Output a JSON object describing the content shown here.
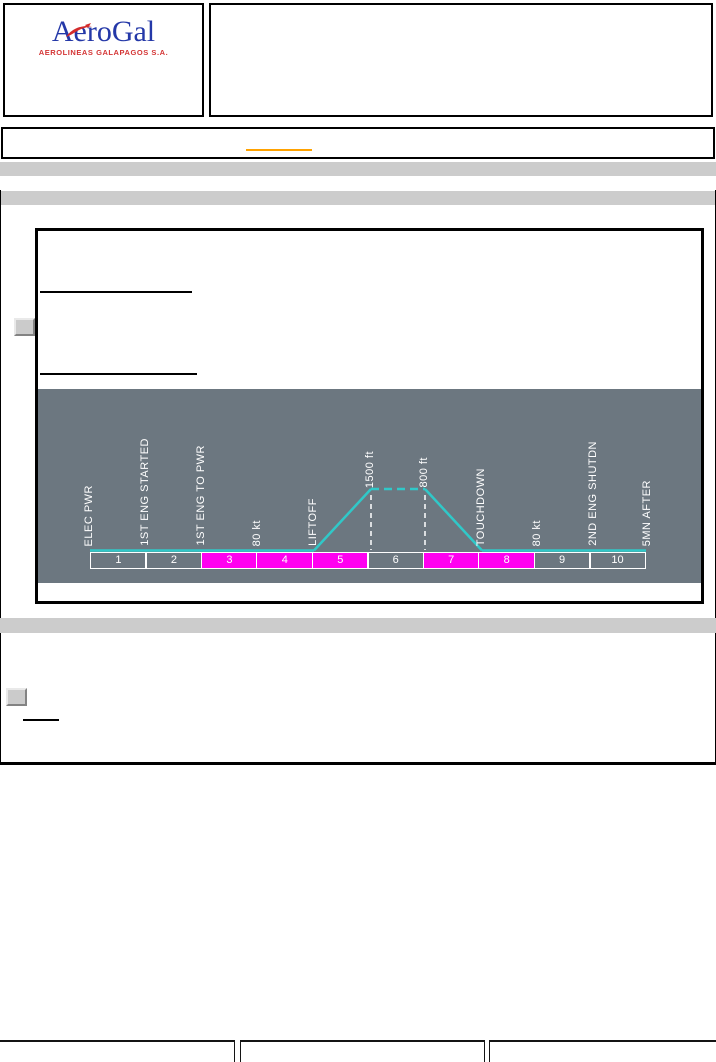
{
  "colors": {
    "accent": "#ffa200",
    "bar": "#cccccc",
    "panel-bg": "#6c7780",
    "hl": "#ff00f0",
    "path": "#30c8c8",
    "logo-blue": "#2438a8",
    "logo-red": "#d43535"
  },
  "header": {
    "logo_title": "AeroGal",
    "logo_subtitle": "AEROLINEAS GALAPAGOS S.A."
  },
  "diagram": {
    "type": "flight-phase-timeline",
    "events": [
      {
        "label": "ELEC PWR"
      },
      {
        "label": "1ST ENG STARTED"
      },
      {
        "label": "1ST ENG TO PWR"
      },
      {
        "label": "80 kt"
      },
      {
        "label": "LIFTOFF"
      },
      {
        "label": "1500 ft"
      },
      {
        "label": "800 ft"
      },
      {
        "label": "TOUCHDOWN"
      },
      {
        "label": "80 kt"
      },
      {
        "label": "2ND ENG SHUTDN"
      },
      {
        "label": "5MN AFTER"
      }
    ],
    "cells": [
      {
        "num": "1",
        "highlighted": false
      },
      {
        "num": "2",
        "highlighted": false
      },
      {
        "num": "3",
        "highlighted": true
      },
      {
        "num": "4",
        "highlighted": true
      },
      {
        "num": "5",
        "highlighted": true
      },
      {
        "num": "6",
        "highlighted": false
      },
      {
        "num": "7",
        "highlighted": true
      },
      {
        "num": "8",
        "highlighted": true
      },
      {
        "num": "9",
        "highlighted": false
      },
      {
        "num": "10",
        "highlighted": false
      }
    ]
  }
}
